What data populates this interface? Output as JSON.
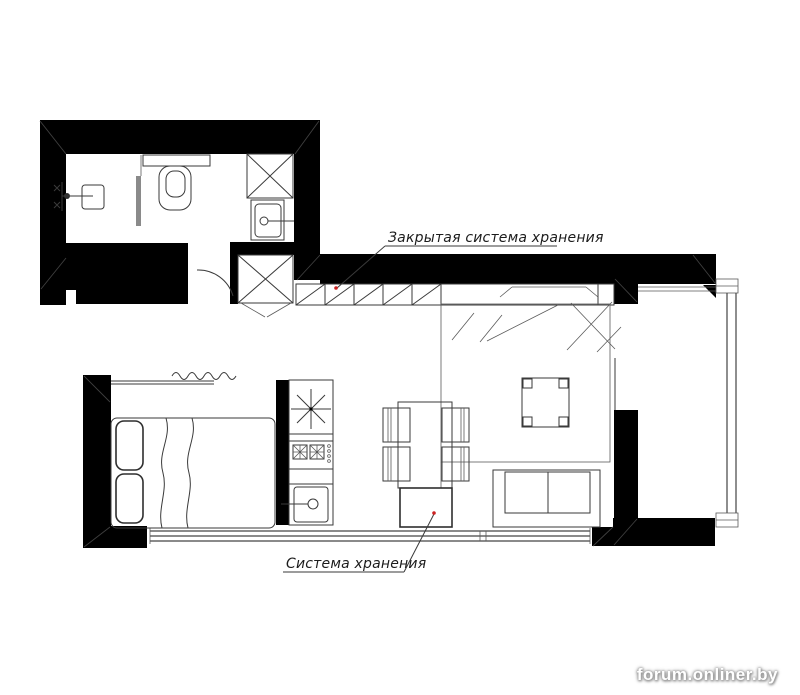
{
  "labels": {
    "closed_storage": "Закрытая система хранения",
    "storage": "Система хранения"
  },
  "watermark": "forum.onliner.by",
  "colors": {
    "walls": "#000000",
    "drawing_lines": "#3a3a3a",
    "leader_dot_red": "#cc2222",
    "shower_glass_gray": "#8a8a8a",
    "watermark_text": "#ffffff"
  },
  "symbols": {
    "ventilation_shaft": "crossed-square",
    "wardrobe_column": "crossed-square",
    "closed_storage_cells": "slash-hatched-cells",
    "ceiling_light_or_fridge": "eight-ray-star",
    "stove_burners": "hatched-squares",
    "shower_mixer": "wall-mixer-glyph",
    "door_swing": "quarter-arc"
  }
}
